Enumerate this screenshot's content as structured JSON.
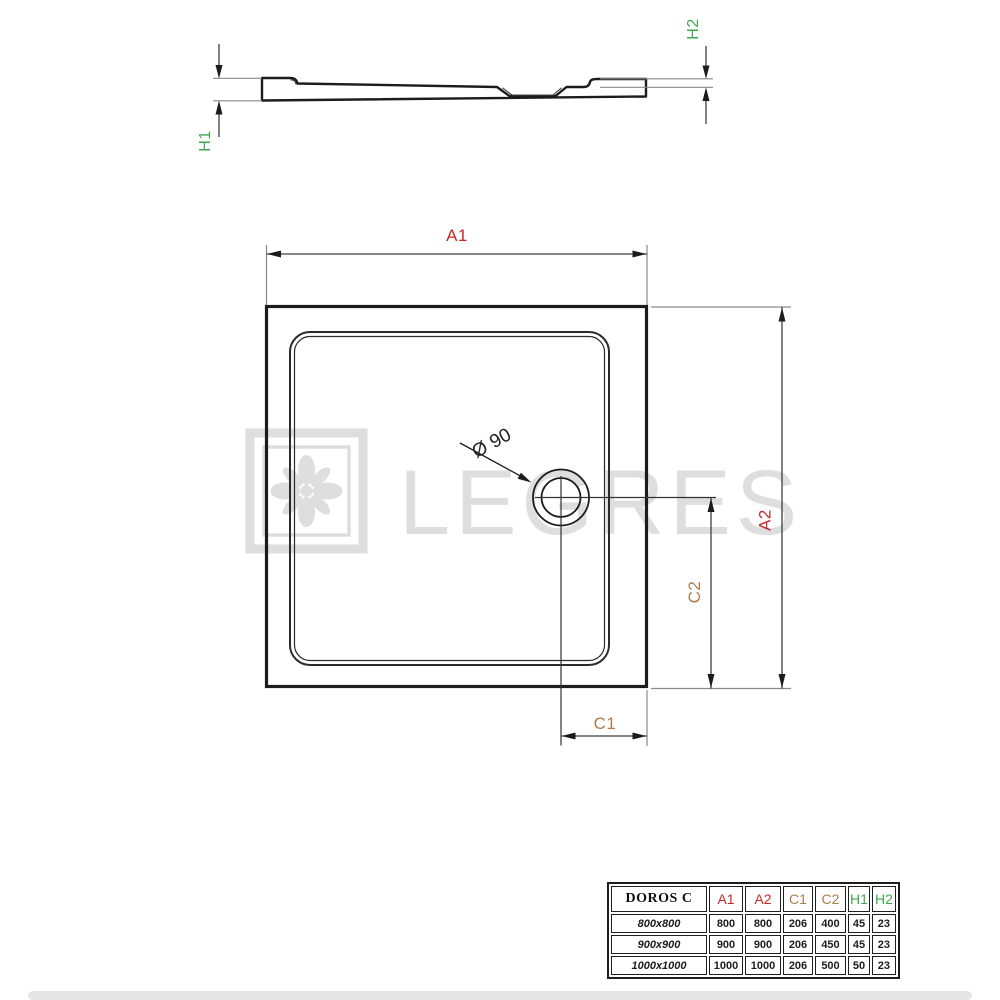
{
  "watermark": {
    "text": "LEGRES"
  },
  "side_view": {
    "h1_label": "H1",
    "h2_label": "H2"
  },
  "plan_view": {
    "a1_label": "A1",
    "a2_label": "A2",
    "c1_label": "C1",
    "c2_label": "C2",
    "drain_label": "Ø 90"
  },
  "colors": {
    "dim_a": "#c62828",
    "dim_c": "#ad7d4e",
    "dim_h": "#3fa94f",
    "line_dark": "#1c1c1c",
    "line_dim": "#3f3f3f",
    "line_ext": "#8a8a8a",
    "watermark": "#dedede"
  },
  "spec_table": {
    "title": "DOROS C",
    "columns": [
      {
        "label": "A1",
        "color_key": "dim_a"
      },
      {
        "label": "A2",
        "color_key": "dim_a"
      },
      {
        "label": "C1",
        "color_key": "dim_c"
      },
      {
        "label": "C2",
        "color_key": "dim_c"
      },
      {
        "label": "H1",
        "color_key": "dim_h"
      },
      {
        "label": "H2",
        "color_key": "dim_h"
      }
    ],
    "rows": [
      {
        "size": "800x800",
        "a1": "800",
        "a2": "800",
        "c1": "206",
        "c2": "400",
        "h1": "45",
        "h2": "23"
      },
      {
        "size": "900x900",
        "a1": "900",
        "a2": "900",
        "c1": "206",
        "c2": "450",
        "h1": "45",
        "h2": "23"
      },
      {
        "size": "1000x1000",
        "a1": "1000",
        "a2": "1000",
        "c1": "206",
        "c2": "500",
        "h1": "50",
        "h2": "23"
      }
    ]
  }
}
